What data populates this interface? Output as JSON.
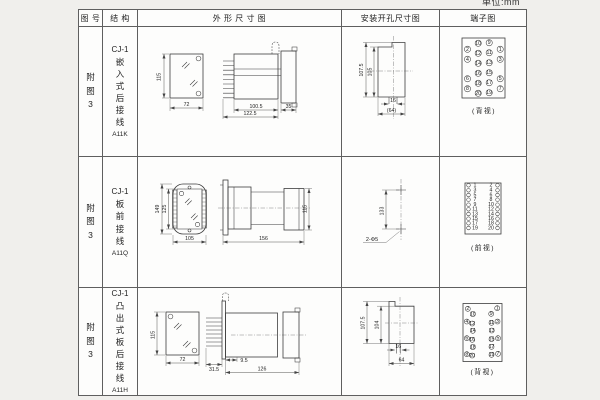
{
  "page": {
    "unit_label": "单位:mm"
  },
  "table": {
    "headers": {
      "fig": "图 号",
      "structure": "结 构",
      "outline": "外 形 尺 寸 图",
      "mount": "安装开孔尺寸图",
      "terminal": "端子图"
    }
  },
  "rows": [
    {
      "fig_no": "附图3",
      "structure": {
        "model": "CJ-1",
        "desc": "嵌入式后接线",
        "code": "A11K"
      },
      "outline": {
        "front_height": "115",
        "front_width": "72",
        "side_depth": "100.5",
        "side_depth_total": "122.5",
        "panel_thickness": "35"
      },
      "mount": {
        "height_outer": "107.5",
        "height_inner": "105",
        "slot_width": "16",
        "width_ref": "(64)"
      },
      "terminal": {
        "view_label": "(背视)",
        "pins": [
          {
            "n": "2",
            "cx": 27.5,
            "cy": 22.3
          },
          {
            "n": "10",
            "cx": 38.2,
            "cy": 16.3
          },
          {
            "n": "9",
            "cx": 49.2,
            "cy": 15.7
          },
          {
            "n": "1",
            "cx": 60.2,
            "cy": 22.3
          },
          {
            "n": "4",
            "cx": 27.5,
            "cy": 32.3
          },
          {
            "n": "12",
            "cx": 38.2,
            "cy": 26.3
          },
          {
            "n": "11",
            "cx": 49.2,
            "cy": 25.7
          },
          {
            "n": "3",
            "cx": 60.2,
            "cy": 32.3
          },
          {
            "n": "14",
            "cx": 38.2,
            "cy": 36.3
          },
          {
            "n": "13",
            "cx": 49.2,
            "cy": 35.7
          },
          {
            "n": "6",
            "cx": 27.5,
            "cy": 51.7
          },
          {
            "n": "16",
            "cx": 38.2,
            "cy": 46.3
          },
          {
            "n": "15",
            "cx": 49.2,
            "cy": 45.7
          },
          {
            "n": "5",
            "cx": 60.2,
            "cy": 51.7
          },
          {
            "n": "8",
            "cx": 27.5,
            "cy": 61.7
          },
          {
            "n": "18",
            "cx": 38.2,
            "cy": 56.3
          },
          {
            "n": "17",
            "cx": 49.2,
            "cy": 55.7
          },
          {
            "n": "7",
            "cx": 60.2,
            "cy": 61.7
          },
          {
            "n": "20",
            "cx": 38.2,
            "cy": 66.3
          },
          {
            "n": "19",
            "cx": 49.2,
            "cy": 65.7
          }
        ]
      }
    },
    {
      "fig_no": "附图3",
      "structure": {
        "model": "CJ-1",
        "desc": "板前接线",
        "code": "A11Q"
      },
      "outline": {
        "front_height_outer": "149",
        "front_height_inner": "125",
        "front_width": "105",
        "side_length": "156",
        "side_height": "115"
      },
      "mount": {
        "hole_spacing": "133",
        "hole_label": "2-Φ5"
      },
      "terminal": {
        "view_label": "(前视)",
        "pins": [
          {
            "n": "1",
            "cx": 28.5,
            "cy": 28.3,
            "tx": 35
          },
          {
            "n": "2",
            "cx": 57.5,
            "cy": 28.3,
            "tx": 51
          },
          {
            "n": "3",
            "cx": 28.5,
            "cy": 33.3,
            "tx": 35
          },
          {
            "n": "4",
            "cx": 57.5,
            "cy": 33.3,
            "tx": 51
          },
          {
            "n": "5",
            "cx": 28.5,
            "cy": 38,
            "tx": 35
          },
          {
            "n": "6",
            "cx": 57.5,
            "cy": 38,
            "tx": 51
          },
          {
            "n": "7",
            "cx": 28.5,
            "cy": 42.7,
            "tx": 35
          },
          {
            "n": "8",
            "cx": 57.5,
            "cy": 42.7,
            "tx": 51
          },
          {
            "n": "9",
            "cx": 28.5,
            "cy": 47.7,
            "tx": 35
          },
          {
            "n": "10",
            "cx": 57.5,
            "cy": 47.7,
            "tx": 51
          },
          {
            "n": "11",
            "cx": 28.5,
            "cy": 52.3,
            "tx": 35
          },
          {
            "n": "12",
            "cx": 57.5,
            "cy": 52.3,
            "tx": 51
          },
          {
            "n": "13",
            "cx": 28.5,
            "cy": 57,
            "tx": 35
          },
          {
            "n": "14",
            "cx": 57.5,
            "cy": 57,
            "tx": 51
          },
          {
            "n": "15",
            "cx": 28.5,
            "cy": 61.7,
            "tx": 35
          },
          {
            "n": "16",
            "cx": 57.5,
            "cy": 61.7,
            "tx": 51
          },
          {
            "n": "17",
            "cx": 28.5,
            "cy": 66.3,
            "tx": 35
          },
          {
            "n": "18",
            "cx": 57.5,
            "cy": 66.3,
            "tx": 51
          },
          {
            "n": "19",
            "cx": 28.5,
            "cy": 71,
            "tx": 35
          },
          {
            "n": "20",
            "cx": 57.5,
            "cy": 71,
            "tx": 51
          }
        ]
      }
    },
    {
      "fig_no": "附图3",
      "structure": {
        "model": "CJ-1",
        "desc": "凸出式板后接线",
        "code": "A11H"
      },
      "outline": {
        "front_height": "115",
        "front_width": "72",
        "fin_depth": "31.5",
        "plate_offset": "9.5",
        "body_depth": "126"
      },
      "mount": {
        "height_outer": "107.5",
        "height_inner": "104",
        "slot_width": "16",
        "width_ref": "64"
      },
      "terminal": {
        "view_label": "(背视)",
        "pins": [
          {
            "n": "2",
            "cx": 27.8,
            "cy": 20.8
          },
          {
            "n": "1",
            "cx": 57.2,
            "cy": 20.2
          },
          {
            "n": "10",
            "cx": 32.8,
            "cy": 26.2
          },
          {
            "n": "9",
            "cx": 51.2,
            "cy": 25.8
          },
          {
            "n": "4",
            "cx": 26.8,
            "cy": 33.5
          },
          {
            "n": "12",
            "cx": 32.2,
            "cy": 35.5
          },
          {
            "n": "11",
            "cx": 51.5,
            "cy": 34.8
          },
          {
            "n": "3",
            "cx": 57.5,
            "cy": 33.5
          },
          {
            "n": "14",
            "cx": 32.8,
            "cy": 42.8
          },
          {
            "n": "13",
            "cx": 51.7,
            "cy": 42.5
          },
          {
            "n": "6",
            "cx": 26.8,
            "cy": 50.2
          },
          {
            "n": "16",
            "cx": 32.2,
            "cy": 51.8
          },
          {
            "n": "15",
            "cx": 51.5,
            "cy": 51.2
          },
          {
            "n": "5",
            "cx": 58,
            "cy": 50.2
          },
          {
            "n": "18",
            "cx": 32.8,
            "cy": 59.2
          },
          {
            "n": "17",
            "cx": 51.5,
            "cy": 58.8
          },
          {
            "n": "8",
            "cx": 26.8,
            "cy": 66.2
          },
          {
            "n": "20",
            "cx": 32.2,
            "cy": 67.5
          },
          {
            "n": "19",
            "cx": 51.5,
            "cy": 66.8
          },
          {
            "n": "7",
            "cx": 58,
            "cy": 65.8
          }
        ]
      }
    }
  ]
}
